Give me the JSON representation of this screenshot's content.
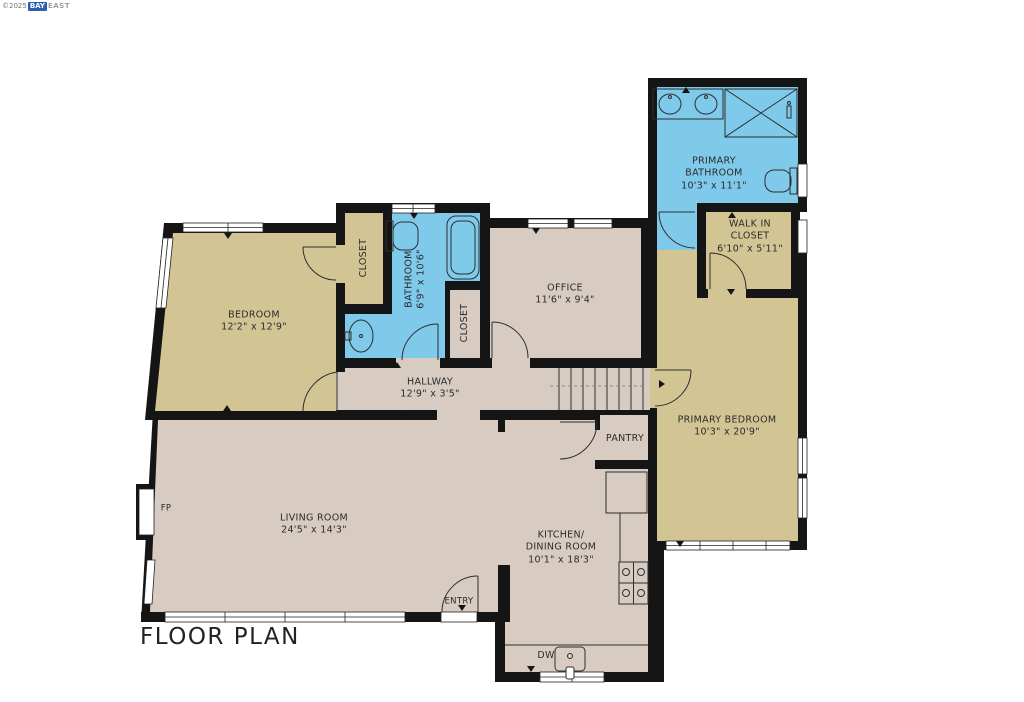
{
  "title": "FLOOR PLAN",
  "watermark": {
    "prefix": "©2025",
    "brand_primary": "BAY",
    "brand_secondary": "EAST"
  },
  "colors": {
    "wall": "#151515",
    "room_tan": "#d3c593",
    "room_blue": "#7fc9eb",
    "room_beige": "#d8ccc2",
    "outline": "#2e2e2e",
    "label": "#2b2b2b"
  },
  "rooms": {
    "bedroom": {
      "name": "BEDROOM",
      "dims": "12'2\" x 12'9\""
    },
    "closet_bedroom": {
      "name": "CLOSET"
    },
    "bathroom": {
      "name": "BATHROOM",
      "dims": "6'9\" x 10'6\""
    },
    "closet_hall": {
      "name": "CLOSET"
    },
    "office": {
      "name": "OFFICE",
      "dims": "11'6\" x 9'4\""
    },
    "primary_bathroom": {
      "name": "PRIMARY\nBATHROOM",
      "dims": "10'3\" x 11'1\""
    },
    "walk_in_closet": {
      "name": "WALK IN\nCLOSET",
      "dims": "6'10\" x 5'11\""
    },
    "primary_bedroom": {
      "name": "PRIMARY BEDROOM",
      "dims": "10'3\" x 20'9\""
    },
    "hallway": {
      "name": "HALLWAY",
      "dims": "12'9\" x 3'5\""
    },
    "pantry": {
      "name": "PANTRY"
    },
    "living_room": {
      "name": "LIVING ROOM",
      "dims": "24'5\" x 14'3\""
    },
    "kitchen": {
      "name": "KITCHEN/\nDINING ROOM",
      "dims": "10'1\" x 18'3\""
    }
  },
  "annotations": {
    "entry": "ENTRY",
    "fireplace": "FP",
    "dishwasher": "DW"
  }
}
